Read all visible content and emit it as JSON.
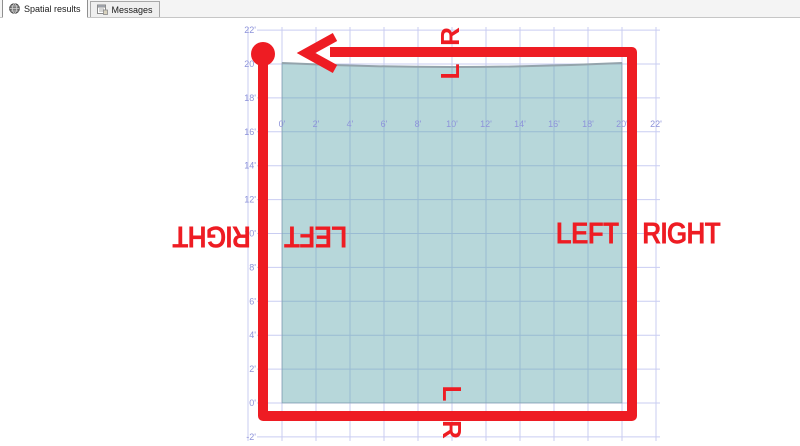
{
  "tab_bar": {
    "tabs": [
      {
        "label": "Spatial results",
        "icon": "globe-icon",
        "active": true
      },
      {
        "label": "Messages",
        "icon": "messages-icon",
        "active": false
      }
    ]
  },
  "chart_data": {
    "type": "spatial-grid",
    "grid": {
      "ft_lines": [
        -2,
        0,
        2,
        4,
        6,
        8,
        10,
        12,
        14,
        16,
        18,
        20,
        22
      ],
      "x0_px": 282,
      "x_px_per_ft": 17.0,
      "y0_px": 403,
      "y_px_per_ft": 16.95,
      "top_px": 27,
      "bottom_px": 441,
      "left_px": 257,
      "right_px": 660,
      "line_color": "#c9cdf2",
      "label_color": "#8d93da",
      "label_font_px": 9
    },
    "x_axis": {
      "row_baseline_px": 127,
      "ticks": [
        {
          "ft": 0,
          "label": "0'"
        },
        {
          "ft": 2,
          "label": "2'"
        },
        {
          "ft": 4,
          "label": "4'"
        },
        {
          "ft": 6,
          "label": "6'"
        },
        {
          "ft": 8,
          "label": "8'"
        },
        {
          "ft": 10,
          "label": "10'"
        },
        {
          "ft": 12,
          "label": "12'"
        },
        {
          "ft": 14,
          "label": "14'"
        },
        {
          "ft": 16,
          "label": "16'"
        },
        {
          "ft": 18,
          "label": "18'"
        },
        {
          "ft": 20,
          "label": "20'"
        },
        {
          "ft": 22,
          "label": "22'"
        }
      ]
    },
    "y_axis": {
      "right_px": 256,
      "ticks": [
        {
          "ft": 22,
          "label": "22'"
        },
        {
          "ft": 20,
          "label": "20'"
        },
        {
          "ft": 18,
          "label": "18'"
        },
        {
          "ft": 16,
          "label": "16'"
        },
        {
          "ft": 14,
          "label": "14'"
        },
        {
          "ft": 12,
          "label": "12'"
        },
        {
          "ft": 10,
          "label": "10'"
        },
        {
          "ft": 8,
          "label": "8'"
        },
        {
          "ft": 6,
          "label": "6'"
        },
        {
          "ft": 4,
          "label": "4'"
        },
        {
          "ft": 2,
          "label": "2'"
        },
        {
          "ft": 0,
          "label": "0'"
        },
        {
          "ft": -2,
          "label": "-2'"
        }
      ]
    },
    "polygon": {
      "x_min_ft": 0,
      "x_max_ft": 20,
      "bottom_ft": 0,
      "top_corner_y_px": 63,
      "top_mid_y_px": 71,
      "fill": "rgba(95,167,172,0.45)",
      "stroke": "rgba(110,140,150,0.5)",
      "top_edge_color": "#94a4ac",
      "top_edge_width": 2
    }
  },
  "red_path": {
    "color": "#ee1c23",
    "stroke_width": 10,
    "polyline_px": [
      [
        263,
        59
      ],
      [
        263,
        416
      ],
      [
        632,
        416
      ],
      [
        632,
        52
      ],
      [
        330,
        52
      ]
    ],
    "arrow": {
      "tip": [
        306,
        53
      ],
      "wing_dx": 29,
      "wing_dy": 16,
      "stroke_width": 9
    },
    "start_circle": {
      "cx": 263,
      "cy": 54,
      "r": 12
    }
  },
  "annotations": {
    "color": "#ee1c23",
    "items": [
      {
        "text": "R",
        "x": 450,
        "y": 37,
        "rot": -90,
        "size": 26,
        "scale_x": 1
      },
      {
        "text": "L",
        "x": 450,
        "y": 72,
        "rot": -90,
        "size": 26,
        "scale_x": 1
      },
      {
        "text": "L",
        "x": 452,
        "y": 393,
        "rot": 90,
        "size": 26,
        "scale_x": 1
      },
      {
        "text": "R",
        "x": 452,
        "y": 429,
        "rot": 90,
        "size": 26,
        "scale_x": 1
      },
      {
        "text": "RIGHT",
        "x": 212,
        "y": 237,
        "rot": 180,
        "size": 31,
        "scale_x": 0.85
      },
      {
        "text": "LEFT",
        "x": 316,
        "y": 237,
        "rot": 180,
        "size": 31,
        "scale_x": 0.85
      },
      {
        "text": "LEFT",
        "x": 587,
        "y": 233,
        "rot": 0,
        "size": 31,
        "scale_x": 0.85
      },
      {
        "text": "RIGHT",
        "x": 681,
        "y": 233,
        "rot": 0,
        "size": 31,
        "scale_x": 0.85
      }
    ]
  }
}
